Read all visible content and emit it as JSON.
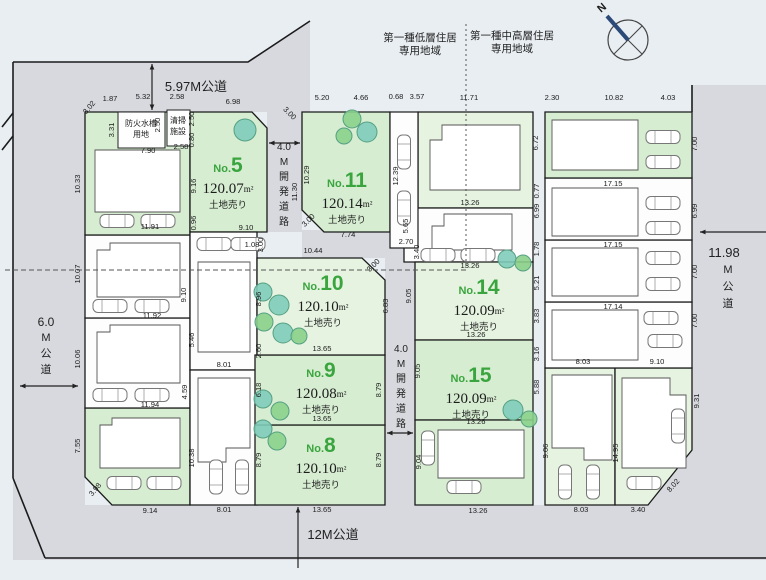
{
  "roads": {
    "top": "5.97M公道",
    "left": "6.0M公道",
    "bottom": "12M公道",
    "right": "11.98M公道",
    "dev_road": "4.0M開発道路"
  },
  "zones": {
    "left_lines": [
      "第一種低層住居",
      "専用地域"
    ],
    "right_lines": [
      "第一種中高層住居",
      "専用地域"
    ]
  },
  "compass": {
    "label": "N"
  },
  "facilities": [
    {
      "lines": [
        "防火水槽",
        "用地"
      ]
    },
    {
      "lines": [
        "清掃",
        "施設"
      ]
    }
  ],
  "lots": [
    {
      "no": "No.1"
    },
    {
      "no": "No.2"
    },
    {
      "no": "No.3"
    },
    {
      "no": "No.4"
    },
    {
      "no": "No.5",
      "area": "120.07",
      "unit": "m²",
      "sale": "土地売り"
    },
    {
      "no": "No.6"
    },
    {
      "no": "No.7"
    },
    {
      "no": "No.8",
      "area": "120.10",
      "unit": "m²",
      "sale": "土地売り"
    },
    {
      "no": "No.9",
      "area": "120.08",
      "unit": "m²",
      "sale": "土地売り"
    },
    {
      "no": "No.10",
      "area": "120.10",
      "unit": "m²",
      "sale": "土地売り"
    },
    {
      "no": "No.11",
      "area": "120.14",
      "unit": "m²",
      "sale": "土地売り"
    },
    {
      "no": "No.12"
    },
    {
      "no": "No.13"
    },
    {
      "no": "No.14",
      "area": "120.09",
      "unit": "m²",
      "sale": "土地売り"
    },
    {
      "no": "No.15",
      "area": "120.09",
      "unit": "m²",
      "sale": "土地売り"
    },
    {
      "no": "No.16"
    },
    {
      "no": "No.17"
    },
    {
      "no": "No.18"
    },
    {
      "no": "No.19"
    },
    {
      "no": "No.20"
    },
    {
      "no": "No.21"
    },
    {
      "no": "No.22"
    }
  ],
  "dims": [
    "3.02",
    "1.87",
    "5.32",
    "2.58",
    "3.31",
    "2.50",
    "2.58",
    "2.50",
    "0.80",
    "7.90",
    "10.33",
    "11.91",
    "6.98",
    "3.00",
    "9.16",
    "0.96",
    "9.10",
    "11.30",
    "1.08",
    "3.00",
    "10.29",
    "5.20",
    "4.66",
    "3.00",
    "7.74",
    "12.39",
    "2.70",
    "0.68",
    "3.57",
    "11.71",
    "6.72",
    "13.26",
    "5.65",
    "0.77",
    "6.99",
    "1.78",
    "3.40",
    "13.26",
    "9.05",
    "5.21",
    "3.83",
    "13.26",
    "9.05",
    "3.16",
    "5.88",
    "13.26",
    "9.04",
    "13.26",
    "10.44",
    "3.00",
    "8.96",
    "6.83",
    "13.65",
    "2.60",
    "6.18",
    "8.79",
    "13.65",
    "8.79",
    "8.79",
    "13.65",
    "5.46",
    "8.01",
    "8.01",
    "10.38",
    "4.59",
    "10.07",
    "9.10",
    "11.92",
    "10.06",
    "11.94",
    "7.55",
    "3.98",
    "9.14",
    "2.30",
    "10.82",
    "4.03",
    "7.00",
    "17.15",
    "6.99",
    "17.15",
    "7.00",
    "17.14",
    "7.00",
    "8.03",
    "9.10",
    "9.06",
    "14.95",
    "9.31",
    "8.03",
    "3.40",
    "8.02"
  ],
  "colors": {
    "lot_green": "#d6edd1",
    "lot_pale": "#e6f3e1",
    "lot_white": "#fcfdfc",
    "road_gray": "#d7d9de",
    "number_green": "#3aa53f",
    "tree_teal": "#7fccba",
    "tree_green": "#8bd08b"
  }
}
